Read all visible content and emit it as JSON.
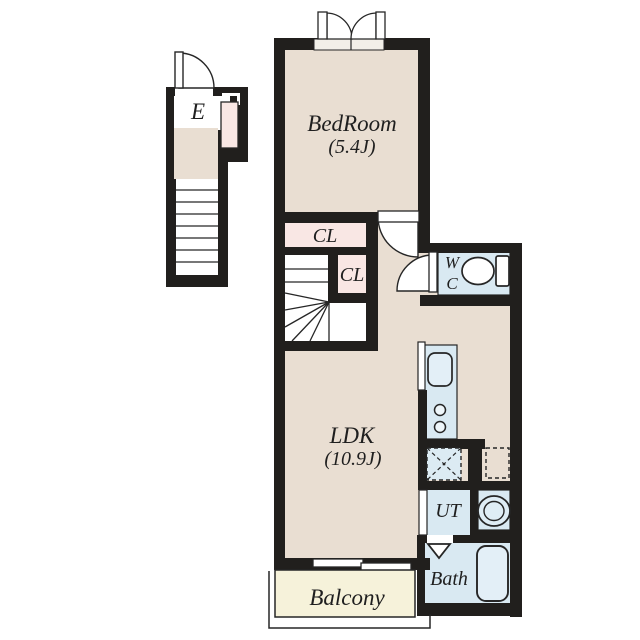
{
  "floorplan": {
    "labels": {
      "entrance": "E",
      "bedroom_name": "BedRoom",
      "bedroom_size": "(5.4J)",
      "closet_upper": "CL",
      "closet_lower": "CL",
      "wc_line1": "W",
      "wc_line2": "C",
      "ldk_name": "LDK",
      "ldk_size": "(10.9J)",
      "utility": "UT",
      "bath": "Bath",
      "balcony": "Balcony"
    },
    "colors": {
      "wall": "#211f1d",
      "floor_beige": "#e9ded2",
      "closet_pink": "#f9e7e4",
      "wet_area_blue": "#d9e9f2",
      "fixture_blue": "#e3eff7",
      "balcony_cream": "#f6f2da",
      "background": "#ffffff",
      "line": "#262626"
    }
  }
}
